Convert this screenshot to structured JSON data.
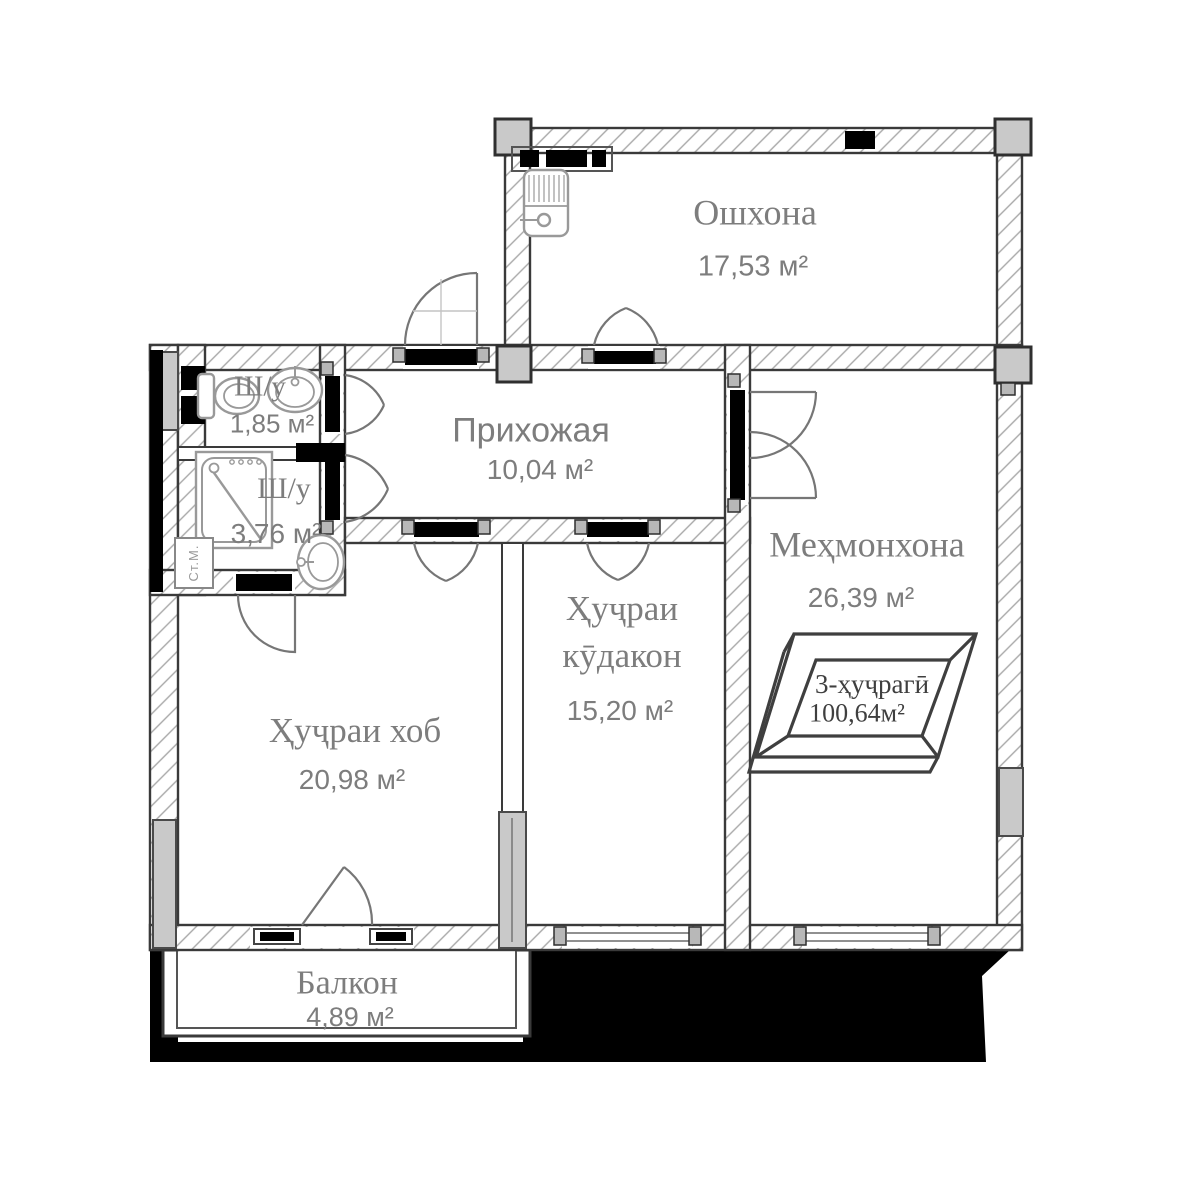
{
  "floor_plan": {
    "badge": {
      "type_label": "3-ҳуҷрагӣ",
      "total_area": "100,64м²"
    },
    "rooms": [
      {
        "key": "kitchen",
        "name": "Ошхона",
        "area": "17,53 м²"
      },
      {
        "key": "hallway",
        "name": "Прихожая",
        "area": "10,04 м²"
      },
      {
        "key": "living_room",
        "name": "Меҳмонхона",
        "area": "26,39 м²"
      },
      {
        "key": "children_room",
        "name": "Ҳуҷраи кӯдакон",
        "area": "15,20 м²"
      },
      {
        "key": "bedroom",
        "name": "Ҳуҷраи хоб",
        "area": "20,98 м²"
      },
      {
        "key": "balcony",
        "name": "Балкон",
        "area": "4,89 м²"
      },
      {
        "key": "bathroom_small",
        "name": "Ш/у",
        "area": "1,85 м²"
      },
      {
        "key": "bathroom_large",
        "name": "Ш/у",
        "area": "3,76 м²"
      }
    ],
    "appliances": {
      "washing_machine_label": "Ст.М."
    },
    "colors": {
      "wall_outline": "#3a3a3a",
      "hatch_line": "#a8a8a8",
      "column_fill": "#c9c9c9",
      "door_arc": "#767676",
      "label_text": "#7d7d7d",
      "badge_text": "#3f3f3f",
      "shadow_fill": "#000000"
    }
  }
}
